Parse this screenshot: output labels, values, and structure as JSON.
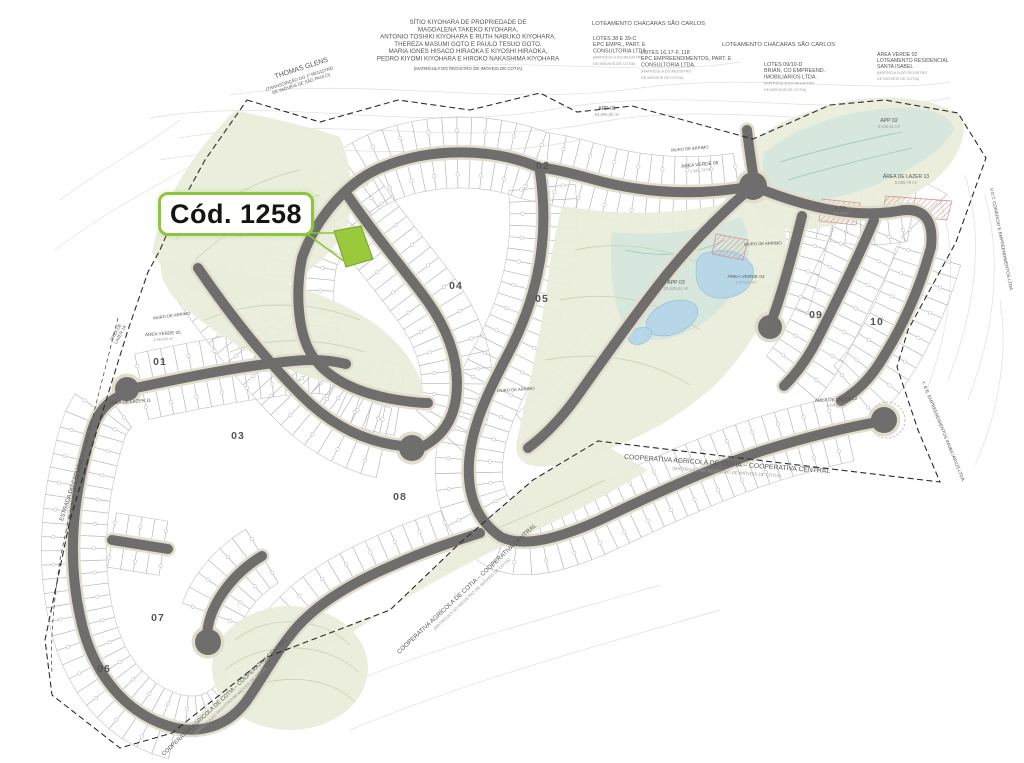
{
  "callout": {
    "label": "Cód. 1258"
  },
  "colors": {
    "road": "#6f6e6c",
    "road_edge": "#e2dccd",
    "terrain": "#e9edda",
    "wetland": "#d5e6de",
    "water": "#b7d7e8",
    "hatch": "#d98c80",
    "highlight": "#9aca3c",
    "callout_border": "#8cc63e",
    "boundary": "#2b2b2b"
  },
  "map": {
    "labels": [
      {
        "t": [
          "SÍTIO KIYOHARA DE PROPRIEDADE DE",
          "MAGDALENA TAKEKO KIYOHARA,",
          "ANTONIO TOSHIKI KIYOHARA E RUTH NABUKO KIYOHARA,",
          "THEREZA MASUMI GOTO E PAULO TESUO GOTO,",
          "MARIA IGNES HISACO HIRAOKA E KIYOSHI HIRAOKA,",
          "PEDRO KIYOMI KIYOHARA E HIROKO NAKASHIMA KIYOHARA"
        ],
        "x": 468,
        "y": 24,
        "s": 6.2,
        "lh": 7.3,
        "a": "middle"
      },
      {
        "t": [
          "(MATRÍCULA DO REGISTRO DE IMÓVEIS DE COTIA)"
        ],
        "x": 468,
        "y": 70,
        "s": 4.4,
        "a": "middle",
        "c": "#999"
      },
      {
        "t": [
          "THOMAS GLENS"
        ],
        "x": 302,
        "y": 70,
        "s": 7,
        "r": -18,
        "a": "middle"
      },
      {
        "t": [
          "(TRANSCRIÇÃO DO 1º REGISTRO",
          "DE IMÓVEIS DE SÃO PAULO)"
        ],
        "x": 300,
        "y": 80,
        "s": 4.4,
        "lh": 5.2,
        "r": -18,
        "a": "middle",
        "c": "#999"
      },
      {
        "t": [
          "LOTEAMENTO CHÁCARAS SÃO CARLOS"
        ],
        "x": 592,
        "y": 25,
        "s": 5.8,
        "a": "start"
      },
      {
        "t": [
          "LOTES 38 E 39-C",
          "EPC EMPR., PART. E",
          "CONSULTORIA LTDA.",
          "(MATRÍCULA DO REGISTRO",
          "DE IMÓVEIS DE COTIA)"
        ],
        "x": 593,
        "y": 40,
        "s": 5.4,
        "lh": 6.2,
        "a": "start",
        "sf": 3,
        "s2": 3.8
      },
      {
        "t": [
          "LOTEAMENTO CHÁCARAS SÃO CARLOS"
        ],
        "x": 722,
        "y": 46,
        "s": 5.8,
        "a": "start"
      },
      {
        "t": [
          "LOTES 16,17-F, 118",
          "EPC EMPREENDIMENTOS, PART. E",
          "CONSULTORIA LTDA.",
          "(MATRÍCULA DO REGISTRO",
          "DE IMÓVEIS DE COTIA)"
        ],
        "x": 641,
        "y": 54,
        "s": 5.4,
        "lh": 6.2,
        "a": "start",
        "sf": 3,
        "s2": 3.8
      },
      {
        "t": [
          "LOTES 09/10-D",
          "BRIAN, CO EMPREEND.",
          "IMOBILIÁRIOS LTDA.",
          "(MATRÍCULA DO REGISTRO",
          "DE IMÓVEIS DE COTIA)"
        ],
        "x": 764,
        "y": 66,
        "s": 5.4,
        "lh": 6.2,
        "a": "start",
        "sf": 3,
        "s2": 3.8
      },
      {
        "t": [
          "ÁREA VERDE 02",
          "LOTEAMENTO RESIDENCIAL",
          "SANTA ISABEL",
          "(MATRÍCULA DO REGISTRO",
          "DE IMÓVEIS DE COTIA)"
        ],
        "x": 877,
        "y": 56,
        "s": 5.2,
        "lh": 6,
        "a": "start",
        "sf": 3,
        "s2": 3.8
      },
      {
        "t": [
          "APP 01",
          "54.805,05 m²"
        ],
        "x": 607,
        "y": 110,
        "s": 5.2,
        "lh": 6,
        "a": "middle",
        "sf": 1,
        "s2": 4.2
      },
      {
        "t": [
          "APP 02",
          "9.234,81 m²"
        ],
        "x": 889,
        "y": 122,
        "s": 5.2,
        "lh": 6,
        "a": "middle",
        "sf": 1,
        "s2": 4.2
      },
      {
        "t": [
          "APP 03",
          "30.929,84 m²"
        ],
        "x": 676,
        "y": 284,
        "s": 5.2,
        "lh": 6,
        "a": "middle",
        "sf": 1,
        "s2": 4.2
      },
      {
        "t": [
          "ÁREA VERDE 06",
          "1.941,74 m²"
        ],
        "x": 700,
        "y": 166,
        "s": 4.8,
        "lh": 5.6,
        "r": -6,
        "a": "middle",
        "sf": 1,
        "s2": 4
      },
      {
        "t": [
          "ÁREA VERDE 04",
          "1.373,87 m²"
        ],
        "x": 746,
        "y": 278,
        "s": 4.8,
        "lh": 5.6,
        "a": "middle",
        "sf": 1,
        "s2": 4
      },
      {
        "t": [
          "ÁREA DE LAZER 13",
          "8.068,79 m²"
        ],
        "x": 906,
        "y": 178,
        "s": 5,
        "lh": 5.8,
        "a": "middle",
        "sf": 1,
        "s2": 4.2
      },
      {
        "t": [
          "E.T.E.",
          "775,75 m²"
        ],
        "x": 841,
        "y": 209,
        "s": 4.6,
        "lh": 5.4,
        "a": "middle",
        "sf": 1,
        "s2": 3.8
      },
      {
        "t": [
          "ÁREA VERDE 05",
          "3.349,60 m²"
        ],
        "x": 163,
        "y": 335,
        "s": 4.6,
        "lh": 5.4,
        "r": -4,
        "a": "middle",
        "sf": 1,
        "s2": 3.8
      },
      {
        "t": [
          "ÁREA DE",
          "LAZER 14"
        ],
        "x": 117,
        "y": 333,
        "s": 4.4,
        "lh": 5,
        "r": -62,
        "a": "middle"
      },
      {
        "t": [
          "ÁREA DE LAZER 11"
        ],
        "x": 130,
        "y": 403,
        "s": 4.6,
        "r": -4,
        "a": "middle"
      },
      {
        "t": [
          "ÁREA DE LAZER 12",
          "1.424,05 m²"
        ],
        "x": 836,
        "y": 401,
        "s": 4.6,
        "lh": 5.4,
        "r": -3,
        "a": "middle",
        "sf": 1,
        "s2": 3.8
      },
      {
        "t": [
          "ÁREA VERDE 01"
        ],
        "x": 254,
        "y": 234,
        "s": 4,
        "r": -10,
        "a": "middle"
      },
      {
        "t": [
          "MURO DE ARRIMO"
        ],
        "x": 172,
        "y": 317,
        "s": 4.2,
        "r": -8,
        "a": "middle",
        "c": "#8d8d8d"
      },
      {
        "t": [
          "MURO DE ARRIMO"
        ],
        "x": 516,
        "y": 391,
        "s": 4.2,
        "r": -4,
        "a": "middle",
        "c": "#8d8d8d"
      },
      {
        "t": [
          "MURO DE ARRIMO"
        ],
        "x": 690,
        "y": 150,
        "s": 4.2,
        "r": -5,
        "a": "middle",
        "c": "#8d8d8d"
      },
      {
        "t": [
          "MURO DE ARRIMO"
        ],
        "x": 763,
        "y": 245,
        "s": 4.2,
        "r": -2,
        "a": "middle",
        "c": "#8d8d8d"
      },
      {
        "t": [
          "COOPERATIVA AGRÍCOLA DE COTIA  –  COOPERATIVA CENTRAL",
          "(MATRÍCULA DO REGISTRO DE IMÓVEIS DE COTIA)"
        ],
        "x": 727,
        "y": 466,
        "s": 6.8,
        "lh": 7.6,
        "r": 4,
        "a": "middle",
        "sf": 1,
        "s2": 4.4
      },
      {
        "t": [
          "COOPERATIVA AGRÍCOLA DE COTIA  –  COOPERATIVA CENTRAL",
          "(MATRÍCULA DO REGISTRO DE IMÓVEIS DE COTIA)"
        ],
        "x": 468,
        "y": 590,
        "s": 6.2,
        "lh": 7,
        "r": -43,
        "a": "middle",
        "sf": 1,
        "s2": 4.2
      },
      {
        "t": [
          "COOPERATIVA AGRÍCOLA DE COTIA  –  COOPERATIVA CENTRAL",
          "(MATRÍCULA DO REGISTRO DE IMÓVEIS DE COTIA)"
        ],
        "x": 226,
        "y": 698,
        "s": 5.6,
        "lh": 6.4,
        "r": -43,
        "a": "middle",
        "sf": 1,
        "s2": 4
      },
      {
        "t": [
          "ESTRADA DO CAPUAVA"
        ],
        "x": 73,
        "y": 490,
        "s": 5.8,
        "r": -72,
        "a": "middle",
        "c": "#777"
      },
      {
        "t": [
          "V.O.T. COMÉRCIO E EMPREENDIMENTOS LTDA."
        ],
        "x": 1000,
        "y": 240,
        "s": 4.6,
        "r": 79,
        "a": "middle",
        "c": "#777"
      },
      {
        "t": [
          "Y. & R. EMPREENDIMENTOS IMOBILIÁRIOS LTDA."
        ],
        "x": 942,
        "y": 432,
        "s": 4.6,
        "r": 68,
        "a": "middle",
        "c": "#777"
      }
    ],
    "quadras": [
      {
        "n": "01",
        "x": 160,
        "y": 365
      },
      {
        "n": "02",
        "x": 543,
        "y": 169
      },
      {
        "n": "03",
        "x": 238,
        "y": 439
      },
      {
        "n": "04",
        "x": 456,
        "y": 289
      },
      {
        "n": "05",
        "x": 542,
        "y": 302
      },
      {
        "n": "06",
        "x": 104,
        "y": 672
      },
      {
        "n": "07",
        "x": 158,
        "y": 621
      },
      {
        "n": "08",
        "x": 400,
        "y": 500
      },
      {
        "n": "09",
        "x": 816,
        "y": 318
      },
      {
        "n": "10",
        "x": 877,
        "y": 325
      }
    ]
  }
}
